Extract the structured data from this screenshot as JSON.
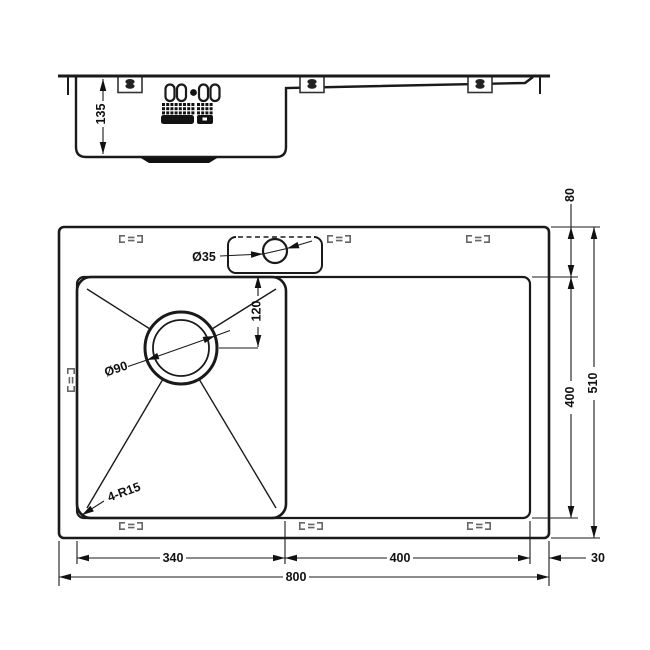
{
  "side_view": {
    "bowl_depth": "135"
  },
  "plan_view": {
    "faucet_hole_diameter": "Ø35",
    "drain_diameter": "Ø90",
    "drain_center_offset": "120",
    "corner_radius": "4-R15"
  },
  "dimensions": {
    "bowl_width": "340",
    "drainboard_width": "400",
    "overall_width": "800",
    "right_margin": "30",
    "top_margin": "80",
    "inner_depth": "400",
    "overall_depth": "510"
  },
  "colors": {
    "line": "#1a1a1a",
    "background": "#ffffff",
    "clip_gray": "#666666"
  }
}
